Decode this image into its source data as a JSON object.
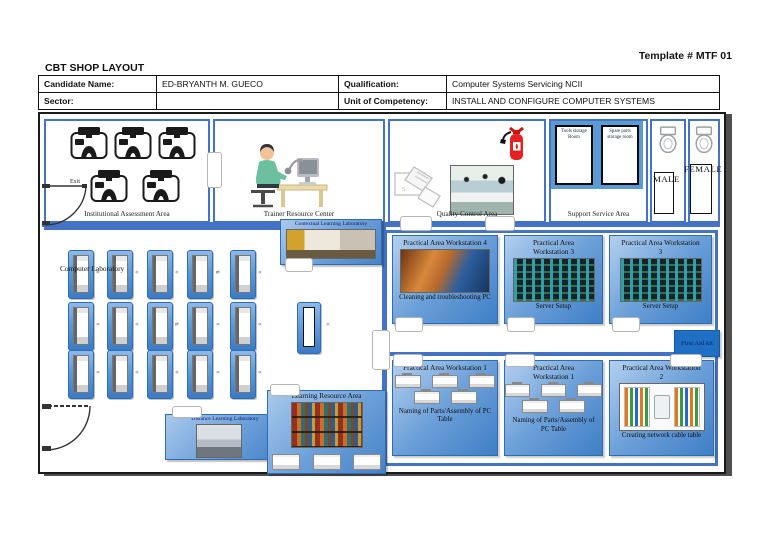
{
  "page": {
    "template_no": "Template # MTF 01",
    "title": "CBT SHOP LAYOUT"
  },
  "header_table": {
    "rows": [
      [
        "Candidate Name:",
        "ED-BRYANTH M. GUECO",
        "Qualification:",
        "Computer Systems Servicing NCII"
      ],
      [
        "Sector:",
        "",
        "Unit of Competency:",
        "INSTALL AND CONFIGURE COMPUTER SYSTEMS"
      ]
    ]
  },
  "floorplan": {
    "institutional_assessment": {
      "label": "Institutional Assessment Area",
      "exit_label": "Exit"
    },
    "trainer_resource": {
      "label": "Trainer Resource Center"
    },
    "quality_control": {
      "label": "Quality Control Area"
    },
    "support_service": {
      "label": "Support Service Area",
      "tools_storage_label": "Tools storage Room",
      "spare_storage_label": "Spare parts storage room"
    },
    "restrooms": {
      "male_label": "MALE",
      "female_label": "FEMALE"
    },
    "computer_laboratory": {
      "label": "Computer Laboratory"
    },
    "contextual_lab": {
      "label": "Contextual Learning Laboratory"
    },
    "distance_lab": {
      "label": "Distance Learning Laboratory"
    },
    "learning_resource": {
      "label": "Learning Resource Area"
    },
    "first_aid": {
      "label": "First Aid kit"
    },
    "practical_top": [
      {
        "title": "Practical Area Workstation 4",
        "caption": "Cleaning and troubleshooting PC"
      },
      {
        "title": "Practical Area Workstation 3",
        "caption": "Server Setup"
      },
      {
        "title": "Practical Area Workstation 3",
        "caption": "Server Setup"
      }
    ],
    "practical_bottom": [
      {
        "title": "Practical Area Workstation 1",
        "caption": "Naming of Parts/Assembly of PC Table"
      },
      {
        "title": "Practical Area Workstation 1",
        "caption": "Naming of Parts/Assembly of PC Table"
      },
      {
        "title": "Practical Area Workstation 2",
        "caption": "Creating network cable table"
      }
    ],
    "colors": {
      "accent_blue": "#4472c4",
      "tile_blue": "#5b9bd5",
      "deep_blue": "#2e75b6",
      "first_aid_blue": "#1f6fc5"
    }
  }
}
